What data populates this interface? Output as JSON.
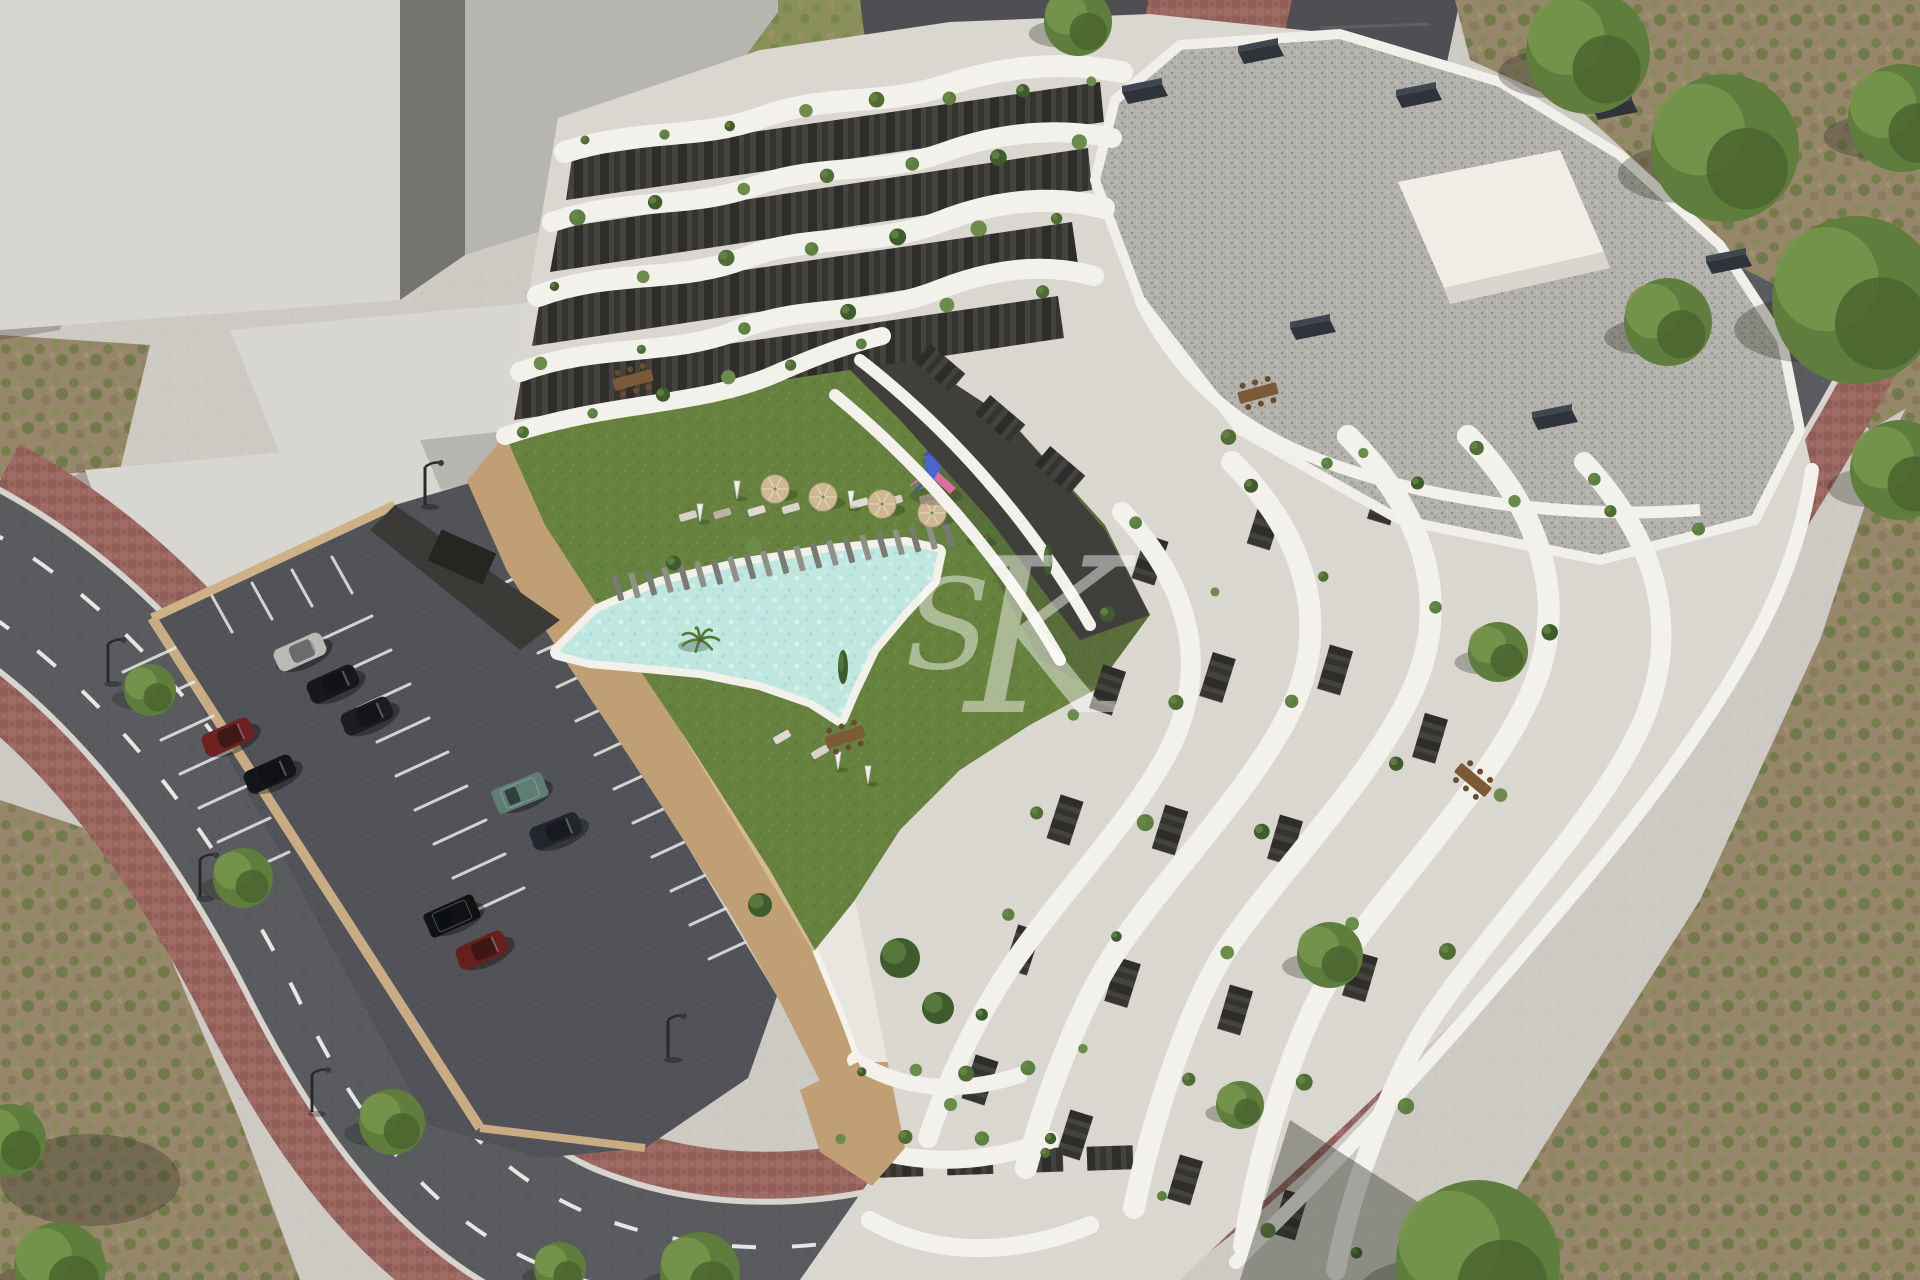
{
  "meta": {
    "title": "Aerial 3D architectural rendering of a modern white terraced apartment complex with communal pool, lawn, playground and parking lot",
    "render_type": "exterior CGI visualization, aerial three-quarter view"
  },
  "watermark": {
    "letters": [
      "S",
      "K"
    ],
    "color": "#ffffff",
    "opacity": 0.45
  },
  "palette": {
    "concrete": "#cdcac4",
    "massing_top": "#d8d6d0",
    "massing_mid": "#b7b5af",
    "massing_dark": "#75746f",
    "scrub_base": "#97876a",
    "scrub_green": "#6d7c43",
    "scrub_green2": "#7f8e4e",
    "scrub_brown": "#8a7a5c",
    "grasstop_base": "#8a9059",
    "grasstop_brown": "#9d8f6a",
    "road": "#5a5b5e",
    "road_dark": "#4e4f52",
    "road_edge": "#d7d4cd",
    "roadline": "#f2f2f0",
    "brick": "#99655f",
    "brick_dark": "#7f4f4a",
    "brick_light": "#aa7570",
    "parking": "#525358",
    "stall": "#e9e9e6",
    "tan": "#bf9f73",
    "tan_light": "#cfb187",
    "tan_dark": "#a98a64",
    "lawn": "#66823e",
    "lawn_dot": "#5c7637",
    "lawn_dot2": "#72914b",
    "pool_water": "#bfe7e0",
    "pool_water_light": "#d9f3ed",
    "pool_rim": "#f2f0ea",
    "plank": "#8f9187",
    "plank_dark": "#797b72",
    "bldg_base": "#dad7d0",
    "terrace": "#e9e6df",
    "band": "#f3f1ec",
    "facade_dark": "#413f3c",
    "window_dark": "#2e2d2b",
    "window_mid": "#444340",
    "gravel": "#b4b2ac",
    "gravel_dot": "#8f8d87",
    "gravel_dot2": "#c7c5bf",
    "chimney": "#2f343b",
    "chimney_top": "#414752",
    "plant1": "#4f6d35",
    "plant2": "#5d7f40",
    "plant3": "#3f5c2c",
    "plant4": "#6b8c4a",
    "tree": "#5f7d3c",
    "tree_dark": "#48632d",
    "tree_light": "#77974c",
    "umbrella_tan": "#cdb893",
    "umbrella_white": "#efefec",
    "lounger_a": "#d8d3c6",
    "lounger_b": "#b9b39f",
    "lounger_c": "#dedad1",
    "wood": "#7b5a38",
    "stall_line": "#e9e9e6",
    "play_blue": "#4a66cc",
    "play_roof": "#3a57c9",
    "play_pink": "#d86fa0",
    "watermark": "#ffffff",
    "shadow": "rgba(35,40,30,0.4)"
  },
  "parking_lot": {
    "stall_banks": [
      {
        "x": 175,
        "y": 648,
        "n": 7,
        "sx": 19,
        "sy": 34,
        "vx": -52,
        "vy": 24
      },
      {
        "x": 320,
        "y": 640,
        "n": 9,
        "sx": 19,
        "sy": 34,
        "vx": 52,
        "vy": -24
      },
      {
        "x": 500,
        "y": 585,
        "n": 12,
        "sx": 19,
        "sy": 34,
        "vx": 52,
        "vy": -24
      },
      {
        "x": 212,
        "y": 596,
        "n": 4,
        "sx": 40,
        "sy": -13,
        "vx": 20,
        "vy": 36
      }
    ],
    "cars": [
      {
        "color": "#b9bab6",
        "x": 300,
        "y": 652,
        "a": -24,
        "type": "sedan"
      },
      {
        "color": "#17181b",
        "x": 333,
        "y": 684,
        "a": -24,
        "type": "sedan"
      },
      {
        "color": "#1c1d20",
        "x": 367,
        "y": 716,
        "a": -24,
        "type": "sedan"
      },
      {
        "color": "#6e2120",
        "x": 228,
        "y": 737,
        "a": -24,
        "type": "sedan"
      },
      {
        "color": "#141518",
        "x": 270,
        "y": 774,
        "a": -24,
        "type": "sedan"
      },
      {
        "color": "#5e7d74",
        "x": 520,
        "y": 793,
        "a": -22,
        "type": "suv"
      },
      {
        "color": "#23262d",
        "x": 556,
        "y": 831,
        "a": -22,
        "type": "sedan"
      },
      {
        "color": "#101214",
        "x": 452,
        "y": 916,
        "a": -24,
        "type": "suv"
      },
      {
        "color": "#671f1d",
        "x": 482,
        "y": 950,
        "a": -24,
        "type": "sedan"
      }
    ],
    "lamps": [
      {
        "x": 108,
        "y": 682
      },
      {
        "x": 200,
        "y": 897
      },
      {
        "x": 312,
        "y": 1112
      },
      {
        "x": 425,
        "y": 505
      },
      {
        "x": 668,
        "y": 1058
      }
    ]
  },
  "trees": {
    "roadside": [
      {
        "x": 150,
        "y": 690,
        "r": 26
      },
      {
        "x": 243,
        "y": 878,
        "r": 30
      },
      {
        "x": 392,
        "y": 1122,
        "r": 33
      },
      {
        "x": 560,
        "y": 1268,
        "r": 26
      },
      {
        "x": 1498,
        "y": 652,
        "r": 30
      },
      {
        "x": 1330,
        "y": 955,
        "r": 33
      },
      {
        "x": 1240,
        "y": 1105,
        "r": 24
      }
    ],
    "clusters": [
      {
        "x": 1588,
        "y": 52,
        "r": 62
      },
      {
        "x": 1725,
        "y": 148,
        "r": 74
      },
      {
        "x": 1856,
        "y": 300,
        "r": 84
      },
      {
        "x": 1902,
        "y": 118,
        "r": 54
      },
      {
        "x": 1668,
        "y": 322,
        "r": 44
      },
      {
        "x": 1900,
        "y": 470,
        "r": 50
      },
      {
        "x": 1078,
        "y": 22,
        "r": 34
      },
      {
        "x": 1478,
        "y": 1262,
        "r": 82
      },
      {
        "x": 700,
        "y": 1272,
        "r": 40
      },
      {
        "x": 60,
        "y": 1268,
        "r": 46
      },
      {
        "x": 10,
        "y": 1140,
        "r": 36
      }
    ]
  },
  "pool_area": {
    "umbrellas_tan": [
      {
        "x": 775,
        "y": 489
      },
      {
        "x": 823,
        "y": 497
      },
      {
        "x": 882,
        "y": 504
      },
      {
        "x": 932,
        "y": 513
      }
    ],
    "umbrellas_white": [
      {
        "x": 737,
        "y": 497
      },
      {
        "x": 851,
        "y": 507
      },
      {
        "x": 700,
        "y": 520
      },
      {
        "x": 838,
        "y": 768
      },
      {
        "x": 868,
        "y": 782
      },
      {
        "x": 568,
        "y": 352
      },
      {
        "x": 596,
        "y": 342
      }
    ],
    "lounger_rows": [
      {
        "x1": 688,
        "y1": 516,
        "x2": 928,
        "y2": 498,
        "n": 8,
        "a": 74
      },
      {
        "x1": 560,
        "y1": 408,
        "x2": 668,
        "y2": 396,
        "n": 4,
        "a": 70
      },
      {
        "x1": 782,
        "y1": 737,
        "x2": 820,
        "y2": 752,
        "n": 2,
        "a": 60
      },
      {
        "x1": 1180,
        "y1": 300,
        "x2": 1300,
        "y2": 330,
        "n": 3,
        "a": 40
      }
    ],
    "deck": {
      "x1": 618,
      "y1": 588,
      "x2": 948,
      "y2": 534,
      "n": 21,
      "len": 26,
      "w": 6,
      "a": 74
    },
    "playground": {
      "x": 932,
      "y": 470
    },
    "palms": [
      {
        "x": 988,
        "y": 535
      },
      {
        "x": 700,
        "y": 640
      }
    ]
  },
  "building": {
    "plant_rows": [
      [
        585,
        140,
        1090,
        78,
        8
      ],
      [
        570,
        212,
        1078,
        140,
        7
      ],
      [
        554,
        286,
        1062,
        214,
        7
      ],
      [
        536,
        360,
        1048,
        288,
        6
      ],
      [
        520,
        430,
        865,
        342,
        6
      ],
      [
        1132,
        520,
        952,
        1108,
        7
      ],
      [
        1246,
        482,
        1052,
        1158,
        7
      ],
      [
        1362,
        452,
        1162,
        1200,
        7
      ],
      [
        1482,
        452,
        1268,
        1234,
        6
      ],
      [
        1598,
        482,
        1358,
        1258,
        6
      ],
      [
        862,
        1072,
        1028,
        1066,
        4
      ],
      [
        842,
        1140,
        1052,
        1134,
        4
      ],
      [
        1235,
        442,
        1695,
        535,
        6
      ],
      [
        600,
        570,
        750,
        545,
        3
      ]
    ],
    "window_rows": [
      [
        1150,
        560,
        980,
        1080,
        5
      ],
      [
        1265,
        525,
        1075,
        1135,
        5
      ],
      [
        1385,
        500,
        1185,
        1180,
        5
      ],
      [
        1500,
        500,
        1290,
        1215,
        4
      ],
      [
        900,
        1165,
        1110,
        1158,
        4
      ],
      [
        940,
        368,
        1060,
        470,
        3
      ]
    ],
    "chimneys": [
      {
        "x": 1142,
        "y": 92
      },
      {
        "x": 1258,
        "y": 52
      },
      {
        "x": 1612,
        "y": 108
      },
      {
        "x": 1726,
        "y": 262
      },
      {
        "x": 1416,
        "y": 96
      },
      {
        "x": 1552,
        "y": 418
      },
      {
        "x": 1310,
        "y": 328
      }
    ],
    "tables": [
      {
        "x": 633,
        "y": 380,
        "a": -15
      },
      {
        "x": 845,
        "y": 737,
        "a": -18
      },
      {
        "x": 1473,
        "y": 780,
        "a": 40
      },
      {
        "x": 1258,
        "y": 393,
        "a": -15
      }
    ],
    "bushes": [
      {
        "x": 900,
        "y": 958,
        "r": 20
      },
      {
        "x": 938,
        "y": 1008,
        "r": 16
      },
      {
        "x": 843,
        "y": 667,
        "r": 9,
        "tall": true
      },
      {
        "x": 1048,
        "y": 560,
        "r": 8,
        "tall": true
      },
      {
        "x": 760,
        "y": 905,
        "r": 12
      }
    ]
  }
}
